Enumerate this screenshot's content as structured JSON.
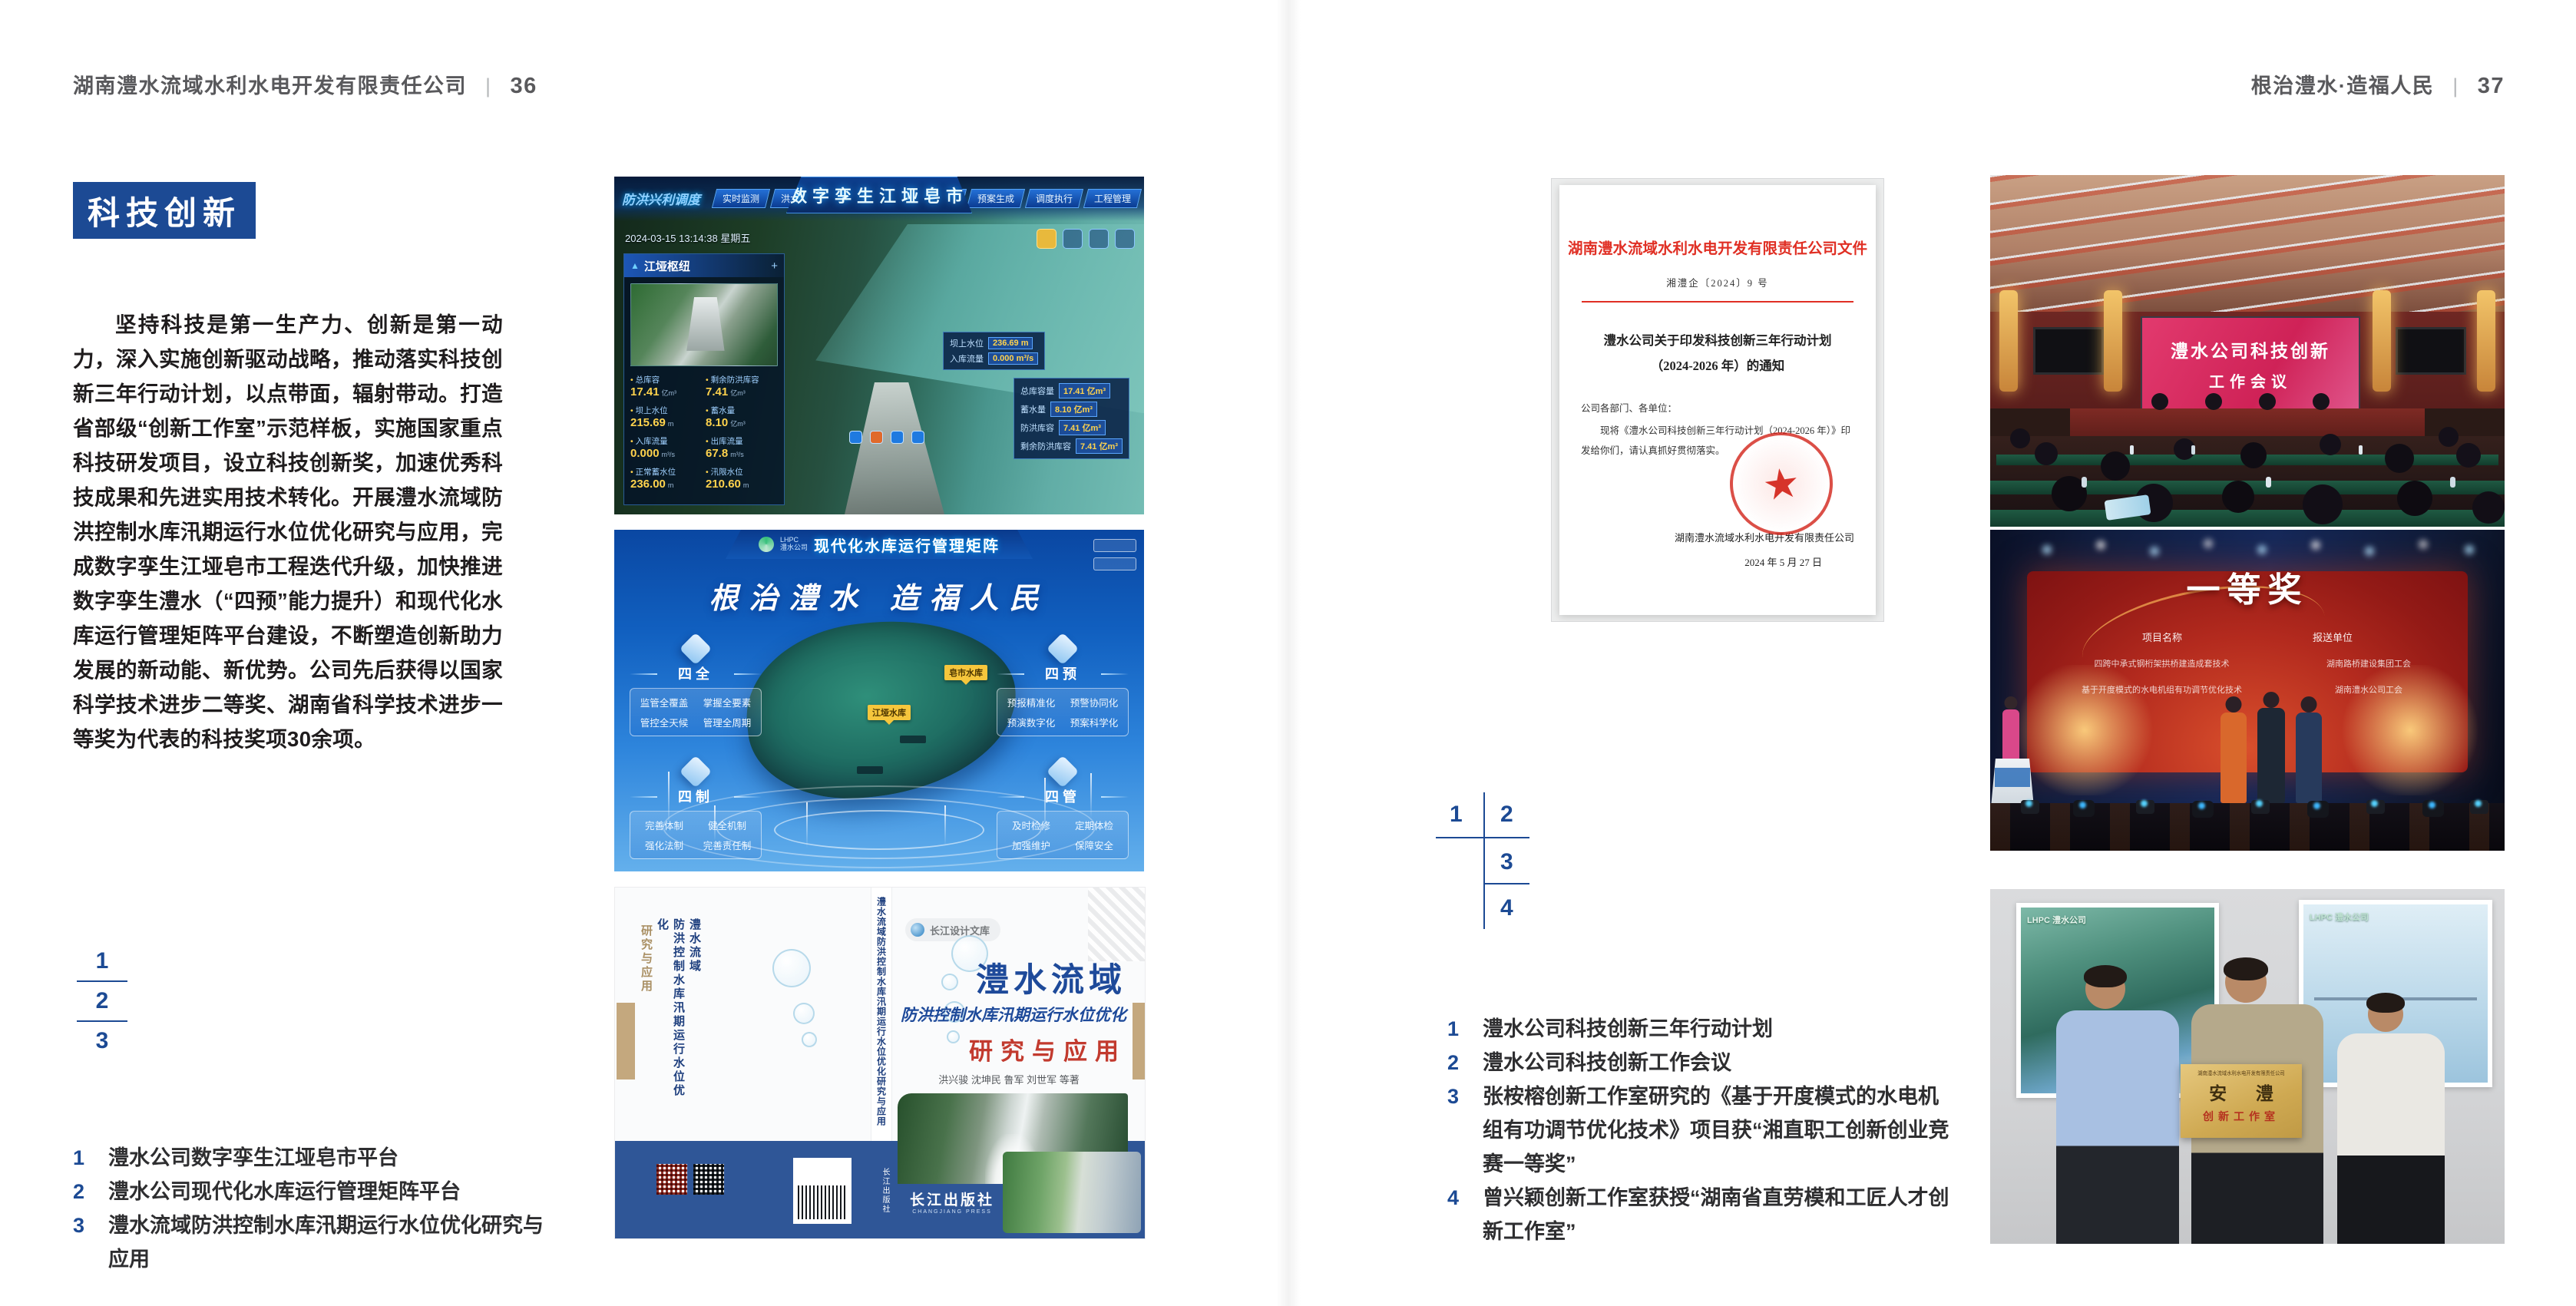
{
  "meta": {
    "accent_blue": "#1c4a94",
    "header_gray": "#59595c",
    "doc_red": "#e02f24",
    "band_navy": "#2f5697",
    "screen_pink": "#d92c5e",
    "stage_red": "#b32a1e",
    "plaque_gold": "#cfa952"
  },
  "left_page": {
    "header": {
      "title": "湖南澧水流域水利水电开发有限责任公司",
      "separator": "|",
      "page_number": "36"
    },
    "section_title": "科技创新",
    "body_paragraph": "坚持科技是第一生产力、创新是第一动力，深入实施创新驱动战略，推动落实科技创新三年行动计划，以点带面，辐射带动。打造省部级“创新工作室”示范样板，实施国家重点科技研发项目，设立科技创新奖，加速优秀科技成果和先进实用技术转化。开展澧水流域防洪控制水库汛期运行水位优化研究与应用，完成数字孪生江垭皂市工程迭代升级，加快推进数字孪生澧水（“四预”能力提升）和现代化水库运行管理矩阵平台建设，不断塑造创新助力发展的新动能、新优势。公司先后获得以国家科学技术进步二等奖、湖南省科学技术进步一等奖为代表的科技奖项30余项。",
    "figure_index": {
      "n1": "1",
      "n2": "2",
      "n3": "3"
    },
    "captions": [
      {
        "num": "1",
        "text": "澧水公司数字孪生江垭皂市平台"
      },
      {
        "num": "2",
        "text": "澧水公司现代化水库运行管理矩阵平台"
      },
      {
        "num": "3",
        "text": "澧水流域防洪控制水库汛期运行水位优化研究与应用"
      }
    ]
  },
  "right_page": {
    "header": {
      "title": "根治澧水·造福人民",
      "separator": "|",
      "page_number": "37"
    },
    "figure_index": {
      "n1": "1",
      "n2": "2",
      "n3": "3",
      "n4": "4"
    },
    "captions": [
      {
        "num": "1",
        "text": "澧水公司科技创新三年行动计划"
      },
      {
        "num": "2",
        "text": "澧水公司科技创新工作会议"
      },
      {
        "num": "3",
        "text": "张桉榕创新工作室研究的《基于开度模式的水电机组有功调节优化技术》项目获“湘直职工创新创业竞赛一等奖”"
      },
      {
        "num": "4",
        "text": "曾兴颖创新工作室获授“湖南省直劳模和工匠人才创新工作室”"
      }
    ]
  },
  "dashboard": {
    "module_label": "防洪兴利调度",
    "title": "数字孪生江垭皂市",
    "tabs_left": [
      "实时监测",
      "洪水预报",
      "防洪预警"
    ],
    "tabs_right": [
      "隐患预测",
      "预案生成",
      "调度执行",
      "工程管理"
    ],
    "timestamp": "2024-03-15 13:14:38 星期五",
    "panel_title": "江垭枢纽",
    "stats": [
      {
        "label": "总库容",
        "value": "17.41",
        "unit": "亿m³"
      },
      {
        "label": "剩余防洪库容",
        "value": "7.41",
        "unit": "亿m³"
      },
      {
        "label": "坝上水位",
        "value": "215.69",
        "unit": "m"
      },
      {
        "label": "蓄水量",
        "value": "8.10",
        "unit": "亿m³"
      },
      {
        "label": "入库流量",
        "value": "0.000",
        "unit": "m³/s"
      },
      {
        "label": "出库流量",
        "value": "67.8",
        "unit": "m³/s"
      },
      {
        "label": "正常蓄水位",
        "value": "236.00",
        "unit": "m"
      },
      {
        "label": "汛限水位",
        "value": "210.60",
        "unit": "m"
      }
    ],
    "popup1": {
      "rows": [
        {
          "label": "坝上水位",
          "value": "236.69 m"
        },
        {
          "label": "入库流量",
          "value": "0.000 m³/s"
        }
      ]
    },
    "popup2": {
      "rows": [
        {
          "label": "总库容量",
          "value": "17.41 亿m³"
        },
        {
          "label": "蓄水量",
          "value": "8.10 亿m³"
        },
        {
          "label": "防洪库容",
          "value": "7.41 亿m³"
        },
        {
          "label": "剩余防洪库容",
          "value": "7.41 亿m³"
        }
      ]
    }
  },
  "matrix": {
    "logo_abbr": "LHPC",
    "logo_name": "澧水公司",
    "title": "现代化水库运行管理矩阵",
    "slogan": "根治澧水 造福人民",
    "panels": [
      {
        "title": "四全",
        "items": [
          "监管全覆盖",
          "掌握全要素",
          "管控全天候",
          "管理全周期"
        ]
      },
      {
        "title": "四预",
        "items": [
          "预报精准化",
          "预警协同化",
          "预演数字化",
          "预案科学化"
        ]
      },
      {
        "title": "四制",
        "items": [
          "完善体制",
          "健全机制",
          "强化法制",
          "完善责任制"
        ]
      },
      {
        "title": "四管",
        "items": [
          "及时检修",
          "定期体检",
          "加强维护",
          "保障安全"
        ]
      }
    ],
    "markers": [
      "皂市水库",
      "江垭水库"
    ]
  },
  "book": {
    "series": "长江设计文库",
    "title_main": "澧水流域",
    "title_sub": "防洪控制水库汛期运行水位优化",
    "title_tail": "研究与应用",
    "authors": "洪兴骏  沈坤民  鲁军  刘世军  等著",
    "publisher": "长江出版社",
    "publisher_en": "CHANGJIANG PRESS",
    "spine_text": "澧水流域防洪控制水库汛期运行水位优化研究与应用",
    "back_title_1": "澧水流域",
    "back_title_2": "防洪控制水库汛期运行水位优化",
    "back_title_3": "研究与应用"
  },
  "document": {
    "header": "湖南澧水流域水利水电开发有限责任公司文件",
    "doc_number": "湘澧企〔2024〕9 号",
    "title_line1": "澧水公司关于印发科技创新三年行动计划",
    "title_line2": "（2024-2026 年）的通知",
    "salutation": "公司各部门、各单位：",
    "body": "现将《澧水公司科技创新三年行动计划（2024-2026 年）》印发给你们，请认真抓好贯彻落实。",
    "seal_star": "★",
    "signer": "湖南澧水流域水利水电开发有限责任公司",
    "date": "2024 年 5 月 27 日"
  },
  "meeting": {
    "screen_line1": "澧水公司科技创新",
    "screen_line2": "工作会议"
  },
  "stage": {
    "award": "一等奖",
    "col_project": "项目名称",
    "col_unit": "报送单位",
    "rows": [
      {
        "project": "四跨中承式钢桁架拱桥建造成套技术",
        "unit": "湖南路桥建设集团工会"
      },
      {
        "project": "基于开度模式的水电机组有功调节优化技术",
        "unit": "湖南澧水公司工会"
      }
    ]
  },
  "group_photo": {
    "plaque_org": "湖南澧水流域水利水电开发有限责任公司",
    "plaque_name": "安 澧",
    "plaque_sub": "创新工作室",
    "poster_logo": "LHPC 澧水公司"
  }
}
